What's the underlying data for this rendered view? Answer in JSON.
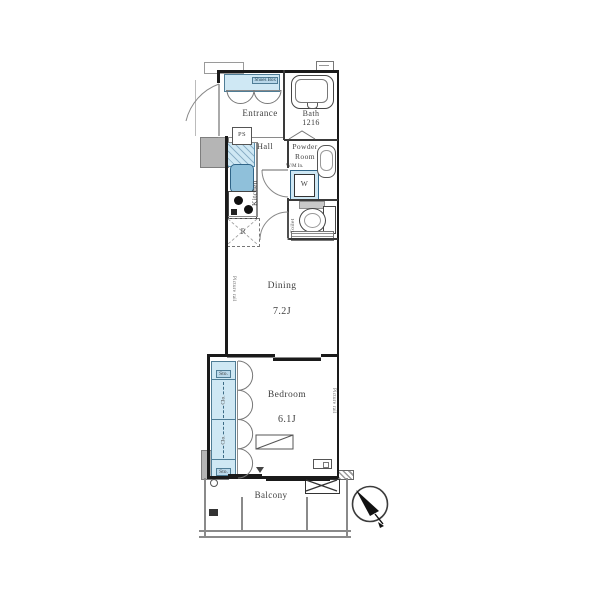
{
  "plan": {
    "type": "apartment-floor-plan",
    "entrance": {
      "label": "Entrance"
    },
    "shoes": {
      "label": "Shoes Box"
    },
    "bath": {
      "label": "Bath",
      "size": "1216"
    },
    "ps": {
      "label": "PS"
    },
    "hall": {
      "label": "Hall"
    },
    "powder": {
      "line1": "Powder",
      "line2": "Room",
      "note": "W/M In."
    },
    "washer": {
      "label": "W"
    },
    "kitchen": {
      "label": "Kitchen"
    },
    "fridge": {
      "label": "R"
    },
    "toilet": {
      "label": "Toilet"
    },
    "dining": {
      "label": "Dining",
      "size": "7.2J"
    },
    "bedroom": {
      "label": "Bedroom",
      "size": "6.1J"
    },
    "closet": {
      "cells": [
        {
          "label": "Sto."
        },
        {
          "label": "Clo."
        },
        {
          "label": "Clo."
        },
        {
          "label": "Sto."
        }
      ]
    },
    "notes": {
      "picture_rail": "Picture rail"
    },
    "balcony": {
      "label": "Balcony"
    },
    "compass_icon": "north-arrow",
    "colors": {
      "fixture_blue": "#cfe8f4",
      "sink_blue": "#8fc0da",
      "wall": "#1a1a1a",
      "gray_block": "#b5b5b5",
      "label_text": "#3f3f3f"
    }
  }
}
